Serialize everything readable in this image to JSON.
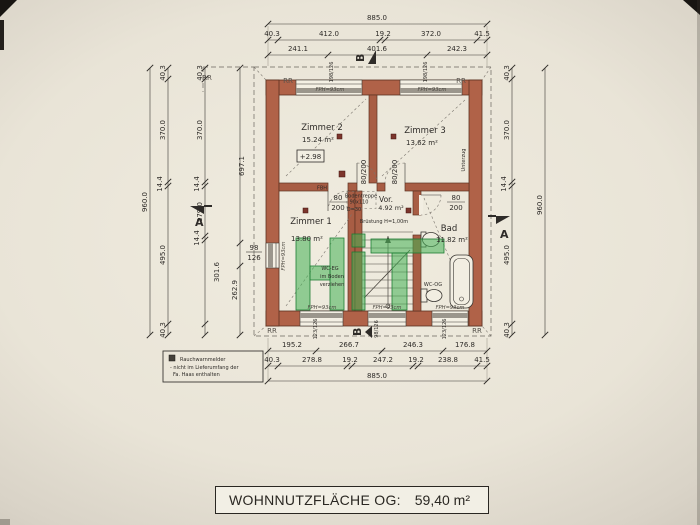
{
  "title_block": {
    "label": "WOHNNUTZFLÄCHE OG:",
    "value": "59,40 m²"
  },
  "legend": {
    "line1": "Rauchwarnmelder",
    "line2": "- nicht im Lieferumfang der",
    "line3": "Fa. Haas enthalten"
  },
  "watermark": {
    "text": "HiT",
    "color": "#44b054"
  },
  "rooms": {
    "z2": {
      "name": "Zimmer 2",
      "area": "15.24 m²",
      "level": "+2.98"
    },
    "z3": {
      "name": "Zimmer 3",
      "area": "13.62 m²"
    },
    "z1": {
      "name": "Zimmer 1",
      "area": "13.80 m²"
    },
    "bad": {
      "name": "Bad",
      "area": "11.82 m²"
    },
    "vor": {
      "name": "Vor.",
      "area": "4.92 m²"
    }
  },
  "annotations": {
    "bodentreppe1": "Bodentreppe",
    "bodentreppe2": "90x110",
    "bodentreppe3": "D=30",
    "bruestung": "Brüstung H=1,00m",
    "wc_og": "WC-OG",
    "wc_eg1": "WC-EG",
    "wc_eg2": "im Boden",
    "wc_eg3": "verziehen",
    "fbh": "FBH",
    "unterzug": "Unterzug",
    "fph": "FPH=93cm",
    "rr": "RR",
    "section_a": "A",
    "section_b": "B"
  },
  "windows": {
    "top_left": "198/126",
    "top_right": "198/126",
    "bottom_left": "123/126",
    "bottom_mid": "98/126",
    "bottom_right": "123/126",
    "left_w": "98",
    "left_h": "126"
  },
  "doors": {
    "w": "80",
    "h": "200",
    "wh": "80/200"
  },
  "dims": {
    "top1": "885.0",
    "top2": [
      "40.3",
      "412.0",
      "19.2",
      "372.0",
      "41.5"
    ],
    "top3": [
      "241.1",
      "401.6",
      "242.3"
    ],
    "bottom1": [
      "195.2",
      "266.7",
      "246.3",
      "176.8"
    ],
    "bottom2": [
      "40.3",
      "278.8",
      "19.2",
      "247.2",
      "19.2",
      "238.8",
      "41.5"
    ],
    "bottom3": "885.0",
    "left_outer": "960.0",
    "left_chain": [
      "40.3",
      "370.0",
      "14.4",
      "495.0",
      "40.3"
    ],
    "left_inner": [
      "40.3",
      "370.0",
      "14.4",
      "179.0",
      "14.4",
      "301.6"
    ],
    "left_extra": [
      "697.1",
      "262.9"
    ],
    "right_chain": [
      "40.3",
      "370.0",
      "14.4",
      "495.0",
      "40.3"
    ],
    "right_outer": "960.0"
  }
}
